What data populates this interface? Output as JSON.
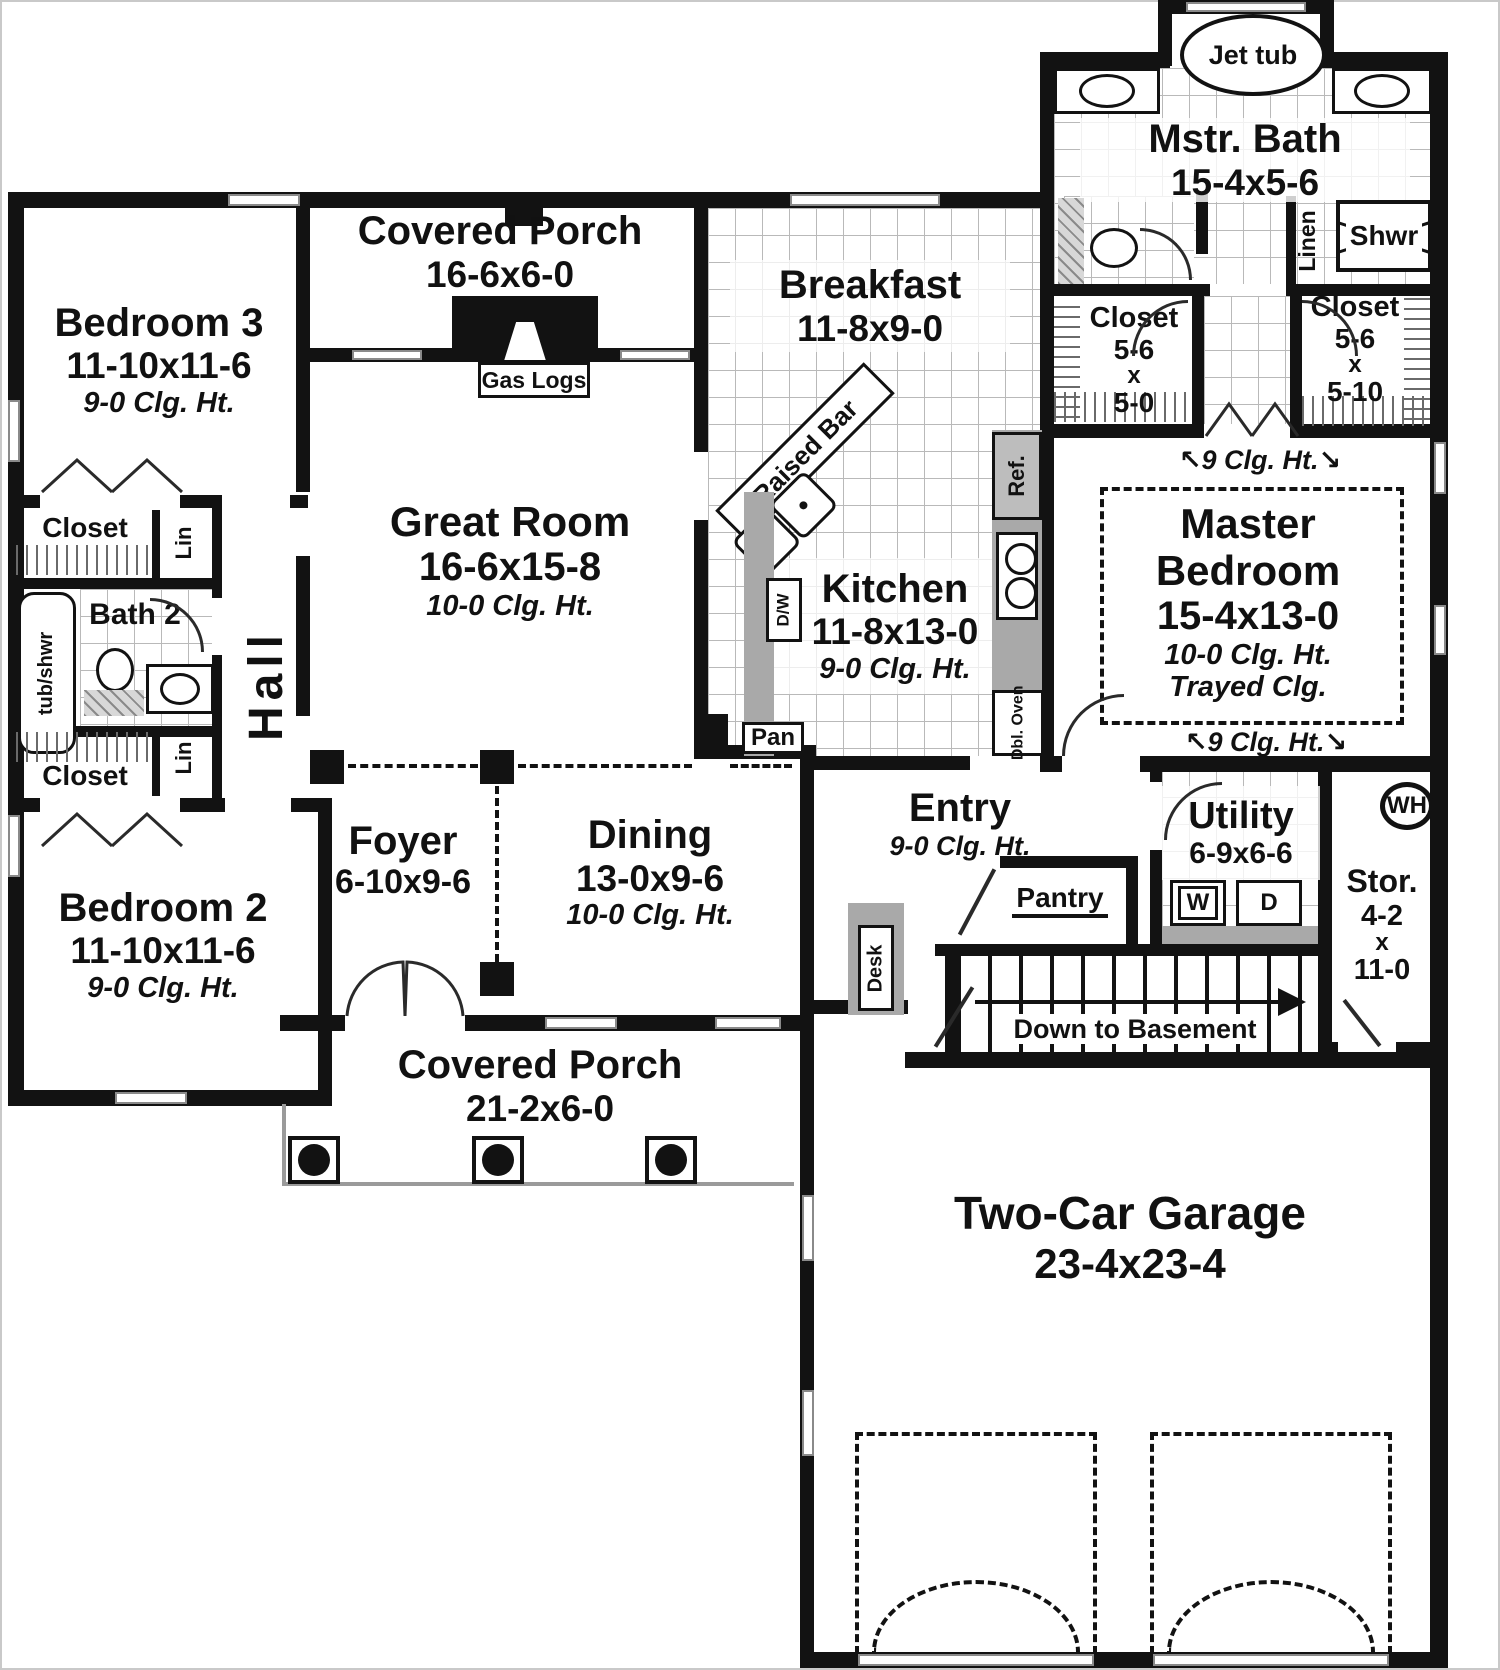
{
  "rooms": {
    "bedroom3": {
      "name": "Bedroom 3",
      "dims": "11-10x11-6",
      "ceiling": "9-0 Clg. Ht."
    },
    "bedroom2": {
      "name": "Bedroom 2",
      "dims": "11-10x11-6",
      "ceiling": "9-0 Clg. Ht."
    },
    "porch_top": {
      "name": "Covered Porch",
      "dims": "16-6x6-0"
    },
    "porch_bottom": {
      "name": "Covered Porch",
      "dims": "21-2x6-0"
    },
    "great_room": {
      "name": "Great Room",
      "dims": "16-6x15-8",
      "ceiling": "10-0 Clg. Ht."
    },
    "breakfast": {
      "name": "Breakfast",
      "dims": "11-8x9-0"
    },
    "kitchen": {
      "name": "Kitchen",
      "dims": "11-8x13-0",
      "ceiling": "9-0 Clg. Ht."
    },
    "master_bath": {
      "name": "Mstr. Bath",
      "dims": "15-4x5-6"
    },
    "master_bedroom": {
      "name": "Master",
      "name2": "Bedroom",
      "dims": "15-4x13-0",
      "ceiling": "10-0 Clg. Ht.",
      "ceiling2": "Trayed Clg."
    },
    "closet_left": {
      "name": "Closet",
      "w": "5-6",
      "x": "x",
      "h": "5-0"
    },
    "closet_right": {
      "name": "Closet",
      "w": "5-6",
      "x": "x",
      "h": "5-10"
    },
    "dining": {
      "name": "Dining",
      "dims": "13-0x9-6",
      "ceiling": "10-0 Clg. Ht."
    },
    "foyer": {
      "name": "Foyer",
      "dims": "6-10x9-6"
    },
    "entry": {
      "name": "Entry",
      "ceiling": "9-0 Clg. Ht."
    },
    "utility": {
      "name": "Utility",
      "dims": "6-9x6-6"
    },
    "storage": {
      "name": "Stor.",
      "w": "4-2",
      "x": "x",
      "h": "11-0"
    },
    "garage": {
      "name": "Two-Car Garage",
      "dims": "23-4x23-4"
    },
    "bath2": {
      "name": "Bath 2"
    },
    "hall": {
      "name": "Hall"
    },
    "pantry": {
      "name": "Pantry"
    }
  },
  "labels": {
    "jet_tub": "Jet tub",
    "linen": "Linen",
    "shwr": "Shwr",
    "gas_logs": "Gas Logs",
    "closet": "Closet",
    "lin": "Lin",
    "tub_shwr": "tub/shwr",
    "raised_bar": "Raised Bar",
    "dw": "D/W",
    "ref": "Ref.",
    "pan": "Pan",
    "dbl1": "Dbl.",
    "dbl2": "Oven",
    "desk": "Desk",
    "washer": "W",
    "dryer": "D",
    "water_heater": "WH",
    "stairs_down": "Down to Basement",
    "clg9": "9 Clg. Ht.",
    "arrow_nw": "↖",
    "arrow_se": "↘"
  },
  "colors": {
    "wall": "#121212",
    "counter": "#a9a9a9",
    "background": "#ffffff"
  }
}
